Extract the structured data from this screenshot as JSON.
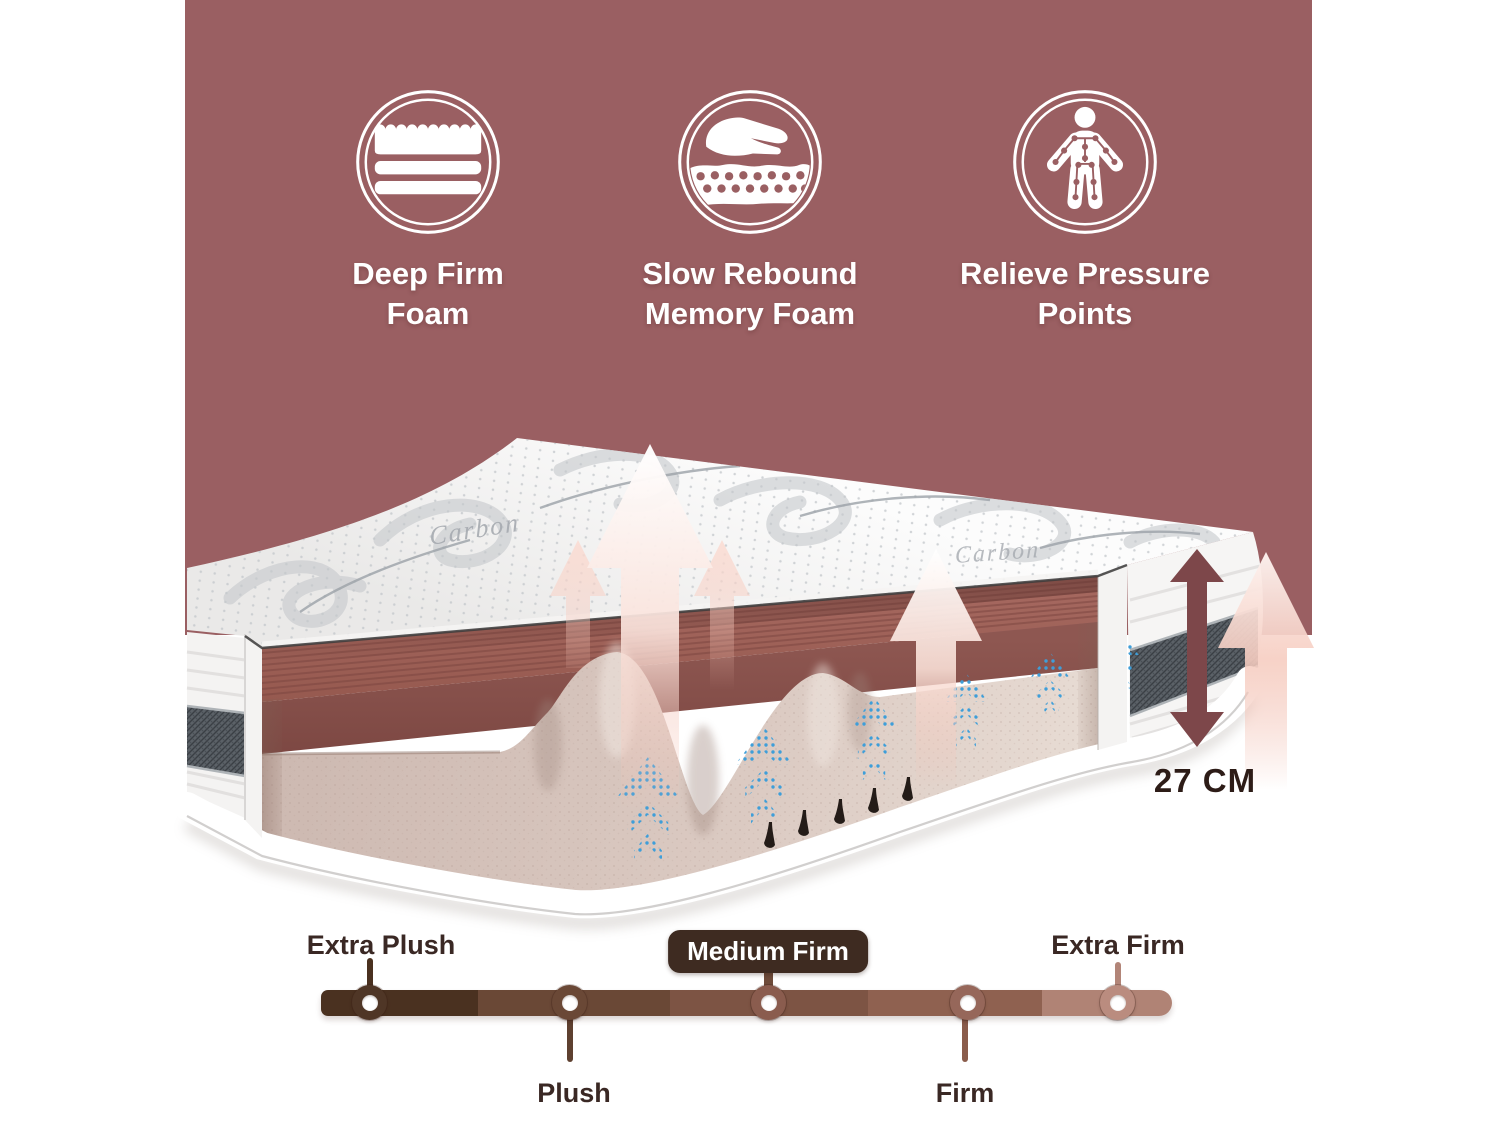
{
  "colors": {
    "page_background": "#FFFFFF",
    "panel_background": "#9A5F62",
    "feature_icon_stroke": "#FFFFFF",
    "feature_title": "#FFFFFF",
    "memory_foam_layer": "#9A6158",
    "memory_foam_face": "#865149",
    "base_foam": "#D5C3BB",
    "airflow_blue": "#3E9ED9",
    "mesh_band": "#5B6167",
    "height_arrow": "#7D474A",
    "height_text": "#2D1C17"
  },
  "features": [
    {
      "icon": "mattress-layers-icon",
      "title_line1": "Deep Firm",
      "title_line2": "Foam"
    },
    {
      "icon": "hand-foam-icon",
      "title_line1": "Slow Rebound",
      "title_line2": "Memory Foam"
    },
    {
      "icon": "pressure-points-icon",
      "title_line1": "Relieve Pressure",
      "title_line2": "Points"
    }
  ],
  "mattress": {
    "fabric_text": "Carbon",
    "height_label": "27 CM"
  },
  "firmness_scale": {
    "selected_level": "Medium Firm",
    "label_color": "#3A2824",
    "badge": {
      "bg": "#3E2B21",
      "text_color": "#FFFFFF"
    },
    "segment_colors": [
      "#4A3120",
      "#6A4836",
      "#7D5444",
      "#8F6150",
      "#B08375"
    ],
    "levels": [
      {
        "label": "Extra Plush",
        "label_position": "above",
        "selected": false,
        "color": "#4F3626",
        "stem_color": "#4A3120"
      },
      {
        "label": "Plush",
        "label_position": "below",
        "selected": false,
        "color": "#6A4836",
        "stem_color": "#5E4030"
      },
      {
        "label": "Medium Firm",
        "label_position": "above",
        "selected": true,
        "color": "#8A5C4E",
        "stem_color": "#6E4B3A"
      },
      {
        "label": "Firm",
        "label_position": "below",
        "selected": false,
        "color": "#96675A",
        "stem_color": "#8A5C4B"
      },
      {
        "label": "Extra Firm",
        "label_position": "above",
        "selected": false,
        "color": "#BA8C7F",
        "stem_color": "#B28578"
      }
    ]
  }
}
